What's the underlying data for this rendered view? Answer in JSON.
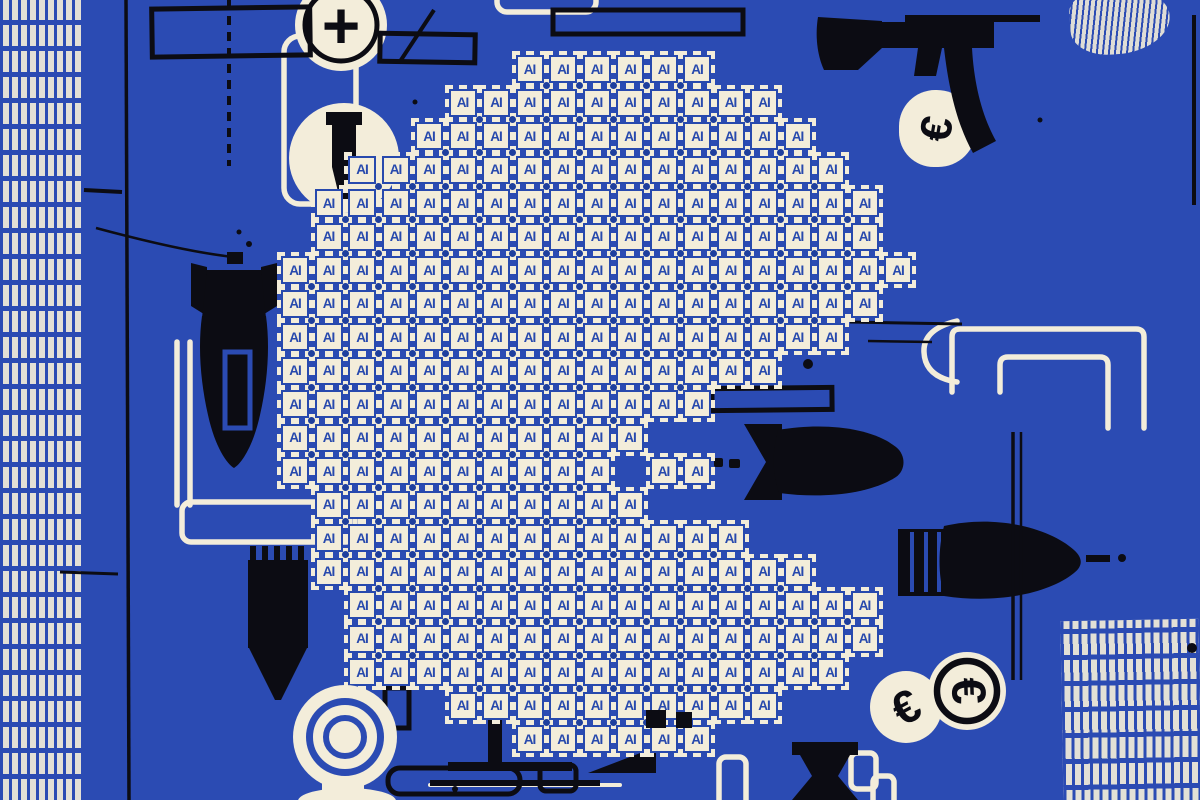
{
  "colors": {
    "background": "#2b4bb3",
    "paper": "#f3edda",
    "ink": "#0c0c13",
    "chip_blue": "#2749ad",
    "node_dot": "#1e3f9e"
  },
  "chip": {
    "label": "AI"
  },
  "icons": {
    "plus_glyph": "+",
    "euro_glyph": "€"
  },
  "chip_grid": {
    "origin_x": 281,
    "origin_y": 55,
    "pitch": 33.5,
    "cell": 28,
    "rows": [
      {
        "row": 0,
        "segments": [
          [
            7,
            12
          ]
        ]
      },
      {
        "row": 1,
        "segments": [
          [
            5,
            14
          ]
        ]
      },
      {
        "row": 2,
        "segments": [
          [
            4,
            15
          ]
        ]
      },
      {
        "row": 3,
        "segments": [
          [
            2,
            16
          ]
        ]
      },
      {
        "row": 4,
        "segments": [
          [
            1,
            17
          ]
        ]
      },
      {
        "row": 5,
        "segments": [
          [
            1,
            17
          ]
        ]
      },
      {
        "row": 6,
        "segments": [
          [
            0,
            18
          ]
        ]
      },
      {
        "row": 7,
        "segments": [
          [
            0,
            17
          ]
        ]
      },
      {
        "row": 8,
        "segments": [
          [
            0,
            16
          ]
        ]
      },
      {
        "row": 9,
        "segments": [
          [
            0,
            14
          ]
        ]
      },
      {
        "row": 10,
        "segments": [
          [
            0,
            12
          ]
        ]
      },
      {
        "row": 11,
        "segments": [
          [
            0,
            10
          ]
        ]
      },
      {
        "row": 12,
        "segments": [
          [
            0,
            9
          ],
          [
            11,
            12
          ]
        ]
      },
      {
        "row": 13,
        "segments": [
          [
            1,
            10
          ]
        ]
      },
      {
        "row": 14,
        "segments": [
          [
            1,
            13
          ]
        ]
      },
      {
        "row": 15,
        "segments": [
          [
            1,
            15
          ]
        ]
      },
      {
        "row": 16,
        "segments": [
          [
            2,
            17
          ]
        ]
      },
      {
        "row": 17,
        "segments": [
          [
            2,
            17
          ]
        ]
      },
      {
        "row": 18,
        "segments": [
          [
            2,
            16
          ]
        ]
      },
      {
        "row": 19,
        "segments": [
          [
            5,
            14
          ]
        ]
      },
      {
        "row": 20,
        "segments": [
          [
            7,
            12
          ]
        ]
      }
    ]
  },
  "dark_squares": [
    {
      "x": 646,
      "y": 710,
      "w": 20,
      "h": 18
    },
    {
      "x": 676,
      "y": 712,
      "w": 16,
      "h": 16
    }
  ]
}
